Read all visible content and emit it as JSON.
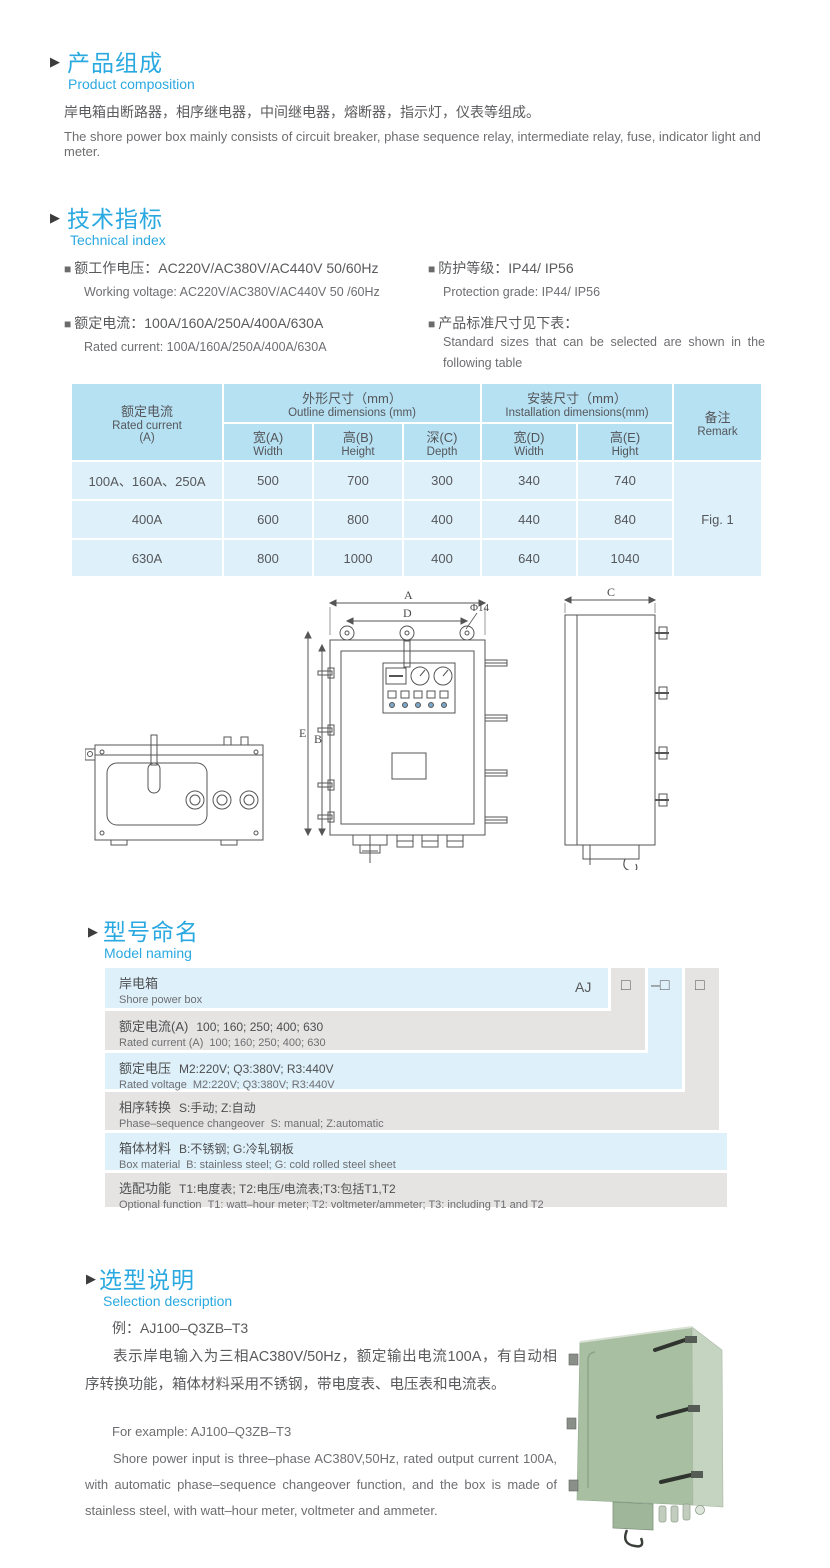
{
  "glyphs": {
    "section_arrow": "▶",
    "bullet": "■"
  },
  "colors": {
    "accent_blue": "#2aa9e1",
    "table_header_bg": "#b6e1f3",
    "table_body_bg": "#def1fa",
    "naming_row_blue": "#def0f9",
    "naming_row_gray": "#e5e4e3",
    "photo_green": "#a8bfa2"
  },
  "product_composition": {
    "title_zh": "产品组成",
    "title_en": "Product  composition",
    "body_zh": "岸电箱由断路器，相序继电器，中间继电器，熔断器，指示灯，仪表等组成。",
    "body_en": "The shore power box mainly consists of circuit breaker, phase sequence relay, intermediate relay, fuse, indicator light and meter."
  },
  "technical_index": {
    "title_zh": "技术指标",
    "title_en": "Technical index",
    "specs_left": [
      {
        "zh": "额工作电压：AC220V/AC380V/AC440V  50/60Hz",
        "en": "Working voltage: AC220V/AC380V/AC440V 50 /60Hz"
      },
      {
        "zh": "额定电流：100A/160A/250A/400A/630A",
        "en": "Rated current: 100A/160A/250A/400A/630A"
      }
    ],
    "specs_right": [
      {
        "zh": "防护等级：IP44/ IP56",
        "en": "Protection grade: IP44/ IP56"
      },
      {
        "zh": "产品标准尺寸见下表：",
        "en": "Standard  sizes  that  can  be  selected  are  shown  in  the following table"
      }
    ]
  },
  "size_table": {
    "rated_current_zh": "额定电流",
    "rated_current_en": "Rated current",
    "rated_current_unit": "(A)",
    "outline_zh": "外形尺寸（mm）",
    "outline_en": "Outline dimensions (mm)",
    "install_zh": "安装尺寸（mm）",
    "install_en": "Installation dimensions(mm)",
    "remark_zh": "备注",
    "remark_en": "Remark",
    "sub_headers": [
      {
        "zh": "宽(A)",
        "en": "Width"
      },
      {
        "zh": "高(B)",
        "en": "Height"
      },
      {
        "zh": "深(C)",
        "en": "Depth"
      },
      {
        "zh": "宽(D)",
        "en": "Width"
      },
      {
        "zh": "高(E)",
        "en": "Hight"
      }
    ],
    "rows": [
      {
        "current": "100A、160A、250A",
        "values": [
          "500",
          "700",
          "300",
          "340",
          "740"
        ]
      },
      {
        "current": "400A",
        "values": [
          "600",
          "800",
          "400",
          "440",
          "840"
        ]
      },
      {
        "current": "630A",
        "values": [
          "800",
          "1000",
          "400",
          "640",
          "1040"
        ]
      }
    ],
    "remark_value": "Fig. 1"
  },
  "drawing": {
    "labels": {
      "A": "A",
      "D": "D",
      "phi": "Φ14",
      "E": "E",
      "B": "B",
      "C": "C"
    }
  },
  "model_naming": {
    "title_zh": "型号命名",
    "title_en": "Model naming",
    "prefix": "AJ",
    "box": "□",
    "dash_box": "–□",
    "rows": [
      {
        "zh_label": "岸电箱",
        "zh_desc": "",
        "en_label": "Shore power box",
        "en_desc": ""
      },
      {
        "zh_label": "额定电流(A)",
        "zh_desc": "100; 160; 250; 400; 630",
        "en_label": "Rated current (A)",
        "en_desc": "100; 160; 250; 400; 630"
      },
      {
        "zh_label": "额定电压",
        "zh_desc": "M2:220V;  Q3:380V;  R3:440V",
        "en_label": "Rated voltage",
        "en_desc": "M2:220V;  Q3:380V;  R3:440V"
      },
      {
        "zh_label": "相序转换",
        "zh_desc": "S:手动; Z:自动",
        "en_label": "Phase–sequence changeover",
        "en_desc": "S: manual;  Z:automatic"
      },
      {
        "zh_label": "箱体材料",
        "zh_desc": "B:不锈钢;  G:冷轧钢板",
        "en_label": "Box material",
        "en_desc": "B: stainless steel; G: cold rolled steel sheet"
      },
      {
        "zh_label": "选配功能",
        "zh_desc": "T1:电度表;  T2:电压/电流表;T3:包括T1,T2",
        "en_label": "Optional function",
        "en_desc": "T1: watt–hour meter; T2: voltmeter/ammeter; T3: including T1 and T2"
      }
    ]
  },
  "selection": {
    "title_zh": "选型说明",
    "title_en": "Selection description",
    "example_zh": "例：AJ100–Q3ZB–T3",
    "para_zh": "表示岸电输入为三相AC380V/50Hz，额定输出电流100A，有自动相序转换功能，箱体材料采用不锈钢，带电度表、电压表和电流表。",
    "example_en": "For example: AJ100–Q3ZB–T3",
    "para_en": "Shore power input is three–phase AC380V,50Hz, rated output current 100A, with automatic phase–sequence changeover function, and the box is made of stainless steel, with watt–hour meter, voltmeter and ammeter."
  }
}
